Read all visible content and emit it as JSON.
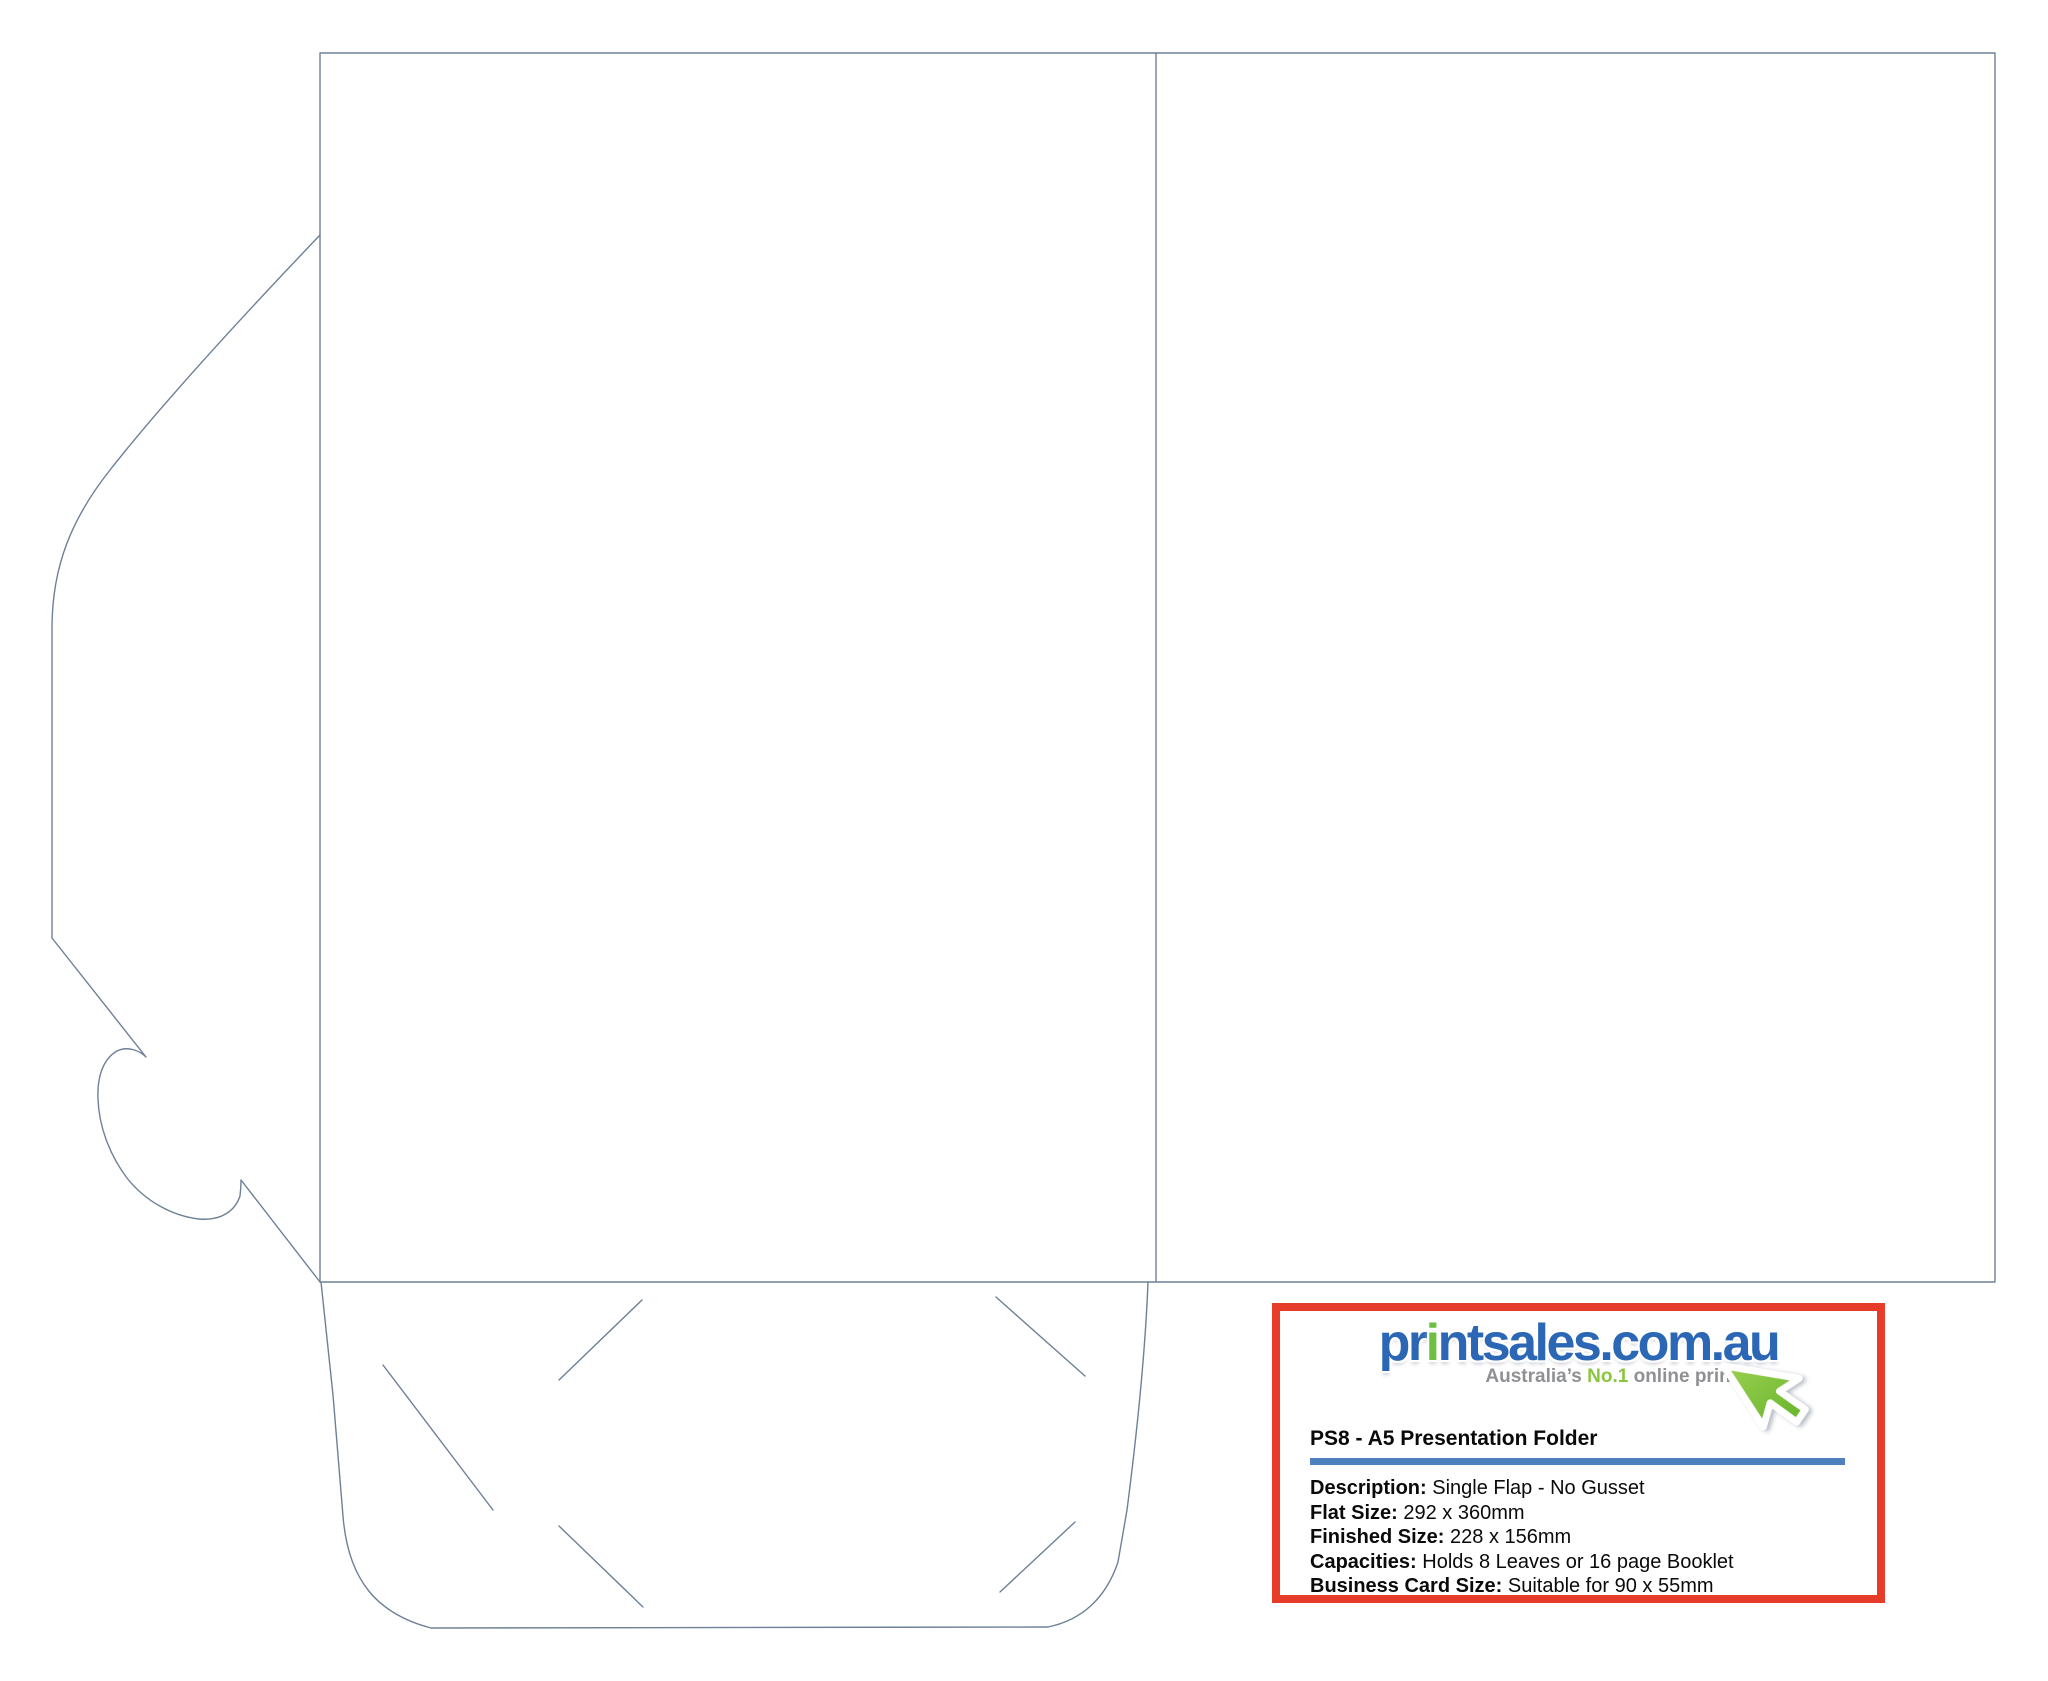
{
  "page": {
    "background_color": "#ffffff",
    "die_line_color": "#6e8097"
  },
  "template_drawing": {
    "description_names": {
      "outline": "folder die-cut outline",
      "fold_line": "center vertical fold line",
      "front_flap": "left tuck flap with thumb notch",
      "pocket": "bottom pocket flap",
      "slits": "business card corner slits"
    }
  },
  "info_box": {
    "border_color": "#e73c2a",
    "logo": {
      "text_before_i": "pr",
      "text_i": "i",
      "text_after_i": "ntsales.com.au",
      "tagline_prefix": "Australia’s ",
      "tagline_no1": "No.1",
      "tagline_suffix": " online printer",
      "blue": "#2b67b4",
      "green": "#6cbf3f",
      "tagline_gray": "#8f9093",
      "tagline_green": "#8cc63e",
      "cursor_icon_color": "#76c043"
    },
    "title": "PS8 - A5 Presentation Folder",
    "divider_color": "#4e80c0",
    "specs": [
      {
        "label": "Description:",
        "value": " Single Flap - No Gusset"
      },
      {
        "label": "Flat Size:",
        "value": " 292 x 360mm"
      },
      {
        "label": "Finished Size:",
        "value": " 228 x 156mm"
      },
      {
        "label": "Capacities:",
        "value": " Holds 8 Leaves or 16 page Booklet"
      },
      {
        "label": "Business Card Size:",
        "value": " Suitable for 90 x 55mm"
      }
    ]
  }
}
